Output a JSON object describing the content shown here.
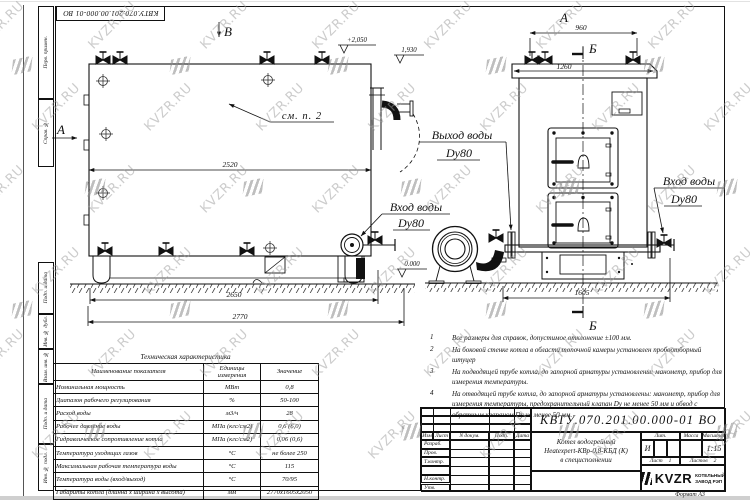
{
  "doc": {
    "number": "КВТУ.070.201.00.000-01 ВО",
    "format": "Формат  А3"
  },
  "watermark": {
    "text": "KVZR.RU"
  },
  "sidebar": {
    "labels": [
      "Перв. примен.",
      "Справ. №",
      "Подп. и дата",
      "Инв. № дубл.",
      "Взам. инв. №",
      "Подп. и дата",
      "Инв. № подл."
    ]
  },
  "views": {
    "side": {
      "label_b": "В",
      "label_a": "А",
      "see_note": "см. п. 2",
      "elev_top": "+2,050",
      "elev_mid": "1,930",
      "elev_zero": "0.000",
      "inlet_line1": "Вход воды",
      "inlet_line2": "Dy80",
      "dim_body": "2520",
      "dim_base": "2650",
      "dim_total": "2770"
    },
    "front": {
      "label_a": "А",
      "label_b_top": "Б",
      "label_b_bottom": "Б",
      "outlet_line1": "Выход воды",
      "outlet_line2": "Dy80",
      "inlet_line1": "Вход воды",
      "inlet_line2": "Dy80",
      "dim_valves": "960",
      "dim_top": "1260",
      "dim_base": "1605"
    }
  },
  "tech_table": {
    "title": "Техническая характеристика",
    "headers": [
      "Наименование показателя",
      "Единицы измерения",
      "Значение"
    ],
    "rows": [
      {
        "name": "Номинальная мощность",
        "unit": "МВт",
        "value": "0,8"
      },
      {
        "name": "Диапазон рабочего регулирования",
        "unit": "%",
        "value": "50-100"
      },
      {
        "name": "Расход воды",
        "unit": "м3/ч",
        "value": "28"
      },
      {
        "name": "Рабочее давление воды",
        "unit": "МПа (кгс/см2)",
        "value": "0,6 (6,0)"
      },
      {
        "name": "Гидравлическое сопротивление котла",
        "unit": "МПа (кгс/см2)",
        "value": "0,06 (0,6)"
      },
      {
        "name": "Температура уходящих газов",
        "unit": "°С",
        "value": "не более 250"
      },
      {
        "name": "Максимальная рабочая температура воды",
        "unit": "°С",
        "value": "115"
      },
      {
        "name": "Температура воды (вход/выход)",
        "unit": "°С",
        "value": "70/95"
      },
      {
        "name": "Габариты котла (длинна х ширина х высота)",
        "unit": "мм",
        "value": "2770х1605х2050"
      }
    ]
  },
  "notes": {
    "items": [
      {
        "num": "1",
        "text": "Все размеры для справок, допустимое отклонение ±100 мм."
      },
      {
        "num": "2",
        "text": "На боковой стенке котла в области топочной камеры установлен пробоотборный штуцер"
      },
      {
        "num": "3",
        "text": "На подводящей трубе котла, до запорной арматуры установлены: манометр, прибор для измерения температуры."
      },
      {
        "num": "4",
        "text": "На отводящей трубе котла, до запорной арматуры установлены: манометр, прибор для измерения температуры, предохранительный клапан Dу не менее 50 мм и обвод с обратным клапаном Dу не менее 50 мм."
      }
    ]
  },
  "title_block": {
    "number": "КВТУ.070.201.00.000-01 ВО",
    "cols": [
      "Изм",
      "Лист",
      "N докум.",
      "Подп.",
      "Дата"
    ],
    "rows": [
      "Разраб.",
      "Пров.",
      "Т.контр.",
      "",
      "Н.контр.",
      "Утв."
    ],
    "name_line1": "Котел водогрейный",
    "name_line2": "Heatexpert-КВр-0,8-КБД (К)",
    "name_line3": "в специсполнении",
    "lit_label": "Лит.",
    "lit_value": "И",
    "mass_label": "Масса",
    "scale_label": "Масштаб",
    "scale_value": "1:15",
    "sheet_label": "Лист",
    "sheet_value": "1",
    "sheets_label": "Листов",
    "sheets_value": "2",
    "company_logo": "KVZR",
    "company_line1": "КОТЕЛЬНЫЙ",
    "company_line2": "ЗАВОД РЭП"
  }
}
